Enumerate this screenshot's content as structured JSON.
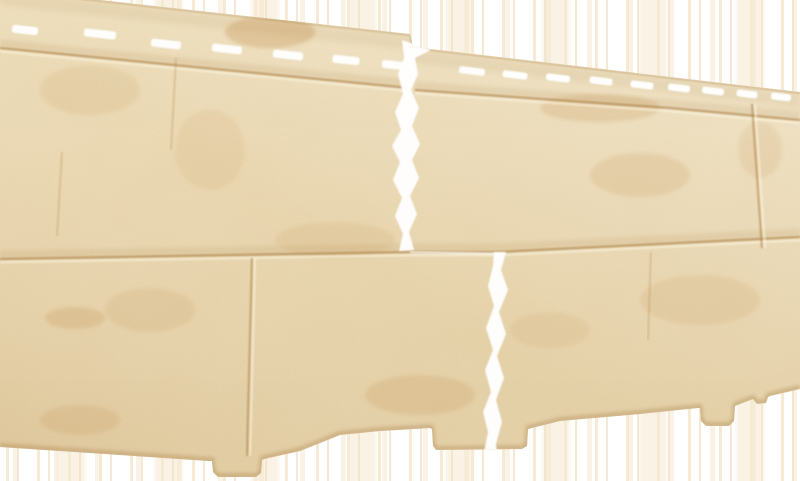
{
  "subject": "Beige stone-textured facade siding panel photographed at an angle on a white background",
  "palette": {
    "bg": "#ffffff",
    "streak_a": "rgba(246,233,210,0.95)",
    "streak_b": "rgba(240,224,193,0.7)",
    "streak_c": "rgba(243,229,203,0.5)",
    "panel_base": "#e9d6a9",
    "grain_dark": "#c29a5e",
    "grain_light": "#f8efd2",
    "blotch": "#c08c4a",
    "seam": "#a97f45",
    "seam_highlight": "#fdf6e0",
    "slot": "#ffffff",
    "gap": "#ffffff",
    "edge_shadow": "#a87e48",
    "sheen_dark": "rgba(194,151,91,0.20)",
    "sheen_light": "rgba(255,253,244,0.33)",
    "vert_top": "rgba(255,251,238,0.20)",
    "vert_bottom": "rgba(176,136,78,0.12)"
  },
  "panel": {
    "outline": "M 0,-11 L 410,34 L 413,47 L 800,92 L 800,389 L 770,396 L 768,397 L 766,403 L 757,404 L 753,399 L 735,406 L 734,421 L 729,426 L 706,426 L 701,421 L 700,408 L 698,408 L 640,414 L 560,421 L 528,429 L 527,446 L 522,449 L 436,450 L 433,446 L 432,429 L 430,428 L 380,431 L 340,435 L 300,451 L 264,459 L 262,460 L 261,473 L 256,477 L 218,477 L 213,472 L 212,461 L 208,461 L 120,455 L 0,447 Z",
    "top_edge": "M 0,-11 L 410,34 L 413,47 L 800,92",
    "bottom_edge": "M 0,447 L 120,455 L 208,461 L 212,461 L 213,472 L 218,477 L 256,477 L 261,473 L 262,460 L 264,459 L 300,451 L 340,435 L 380,431 L 430,428 L 432,429 L 433,446 L 436,450 L 522,449 L 527,446 L 528,429 L 560,421 L 640,414 L 698,408 L 700,408 L 701,421 L 706,426 L 729,426 L 734,421 L 735,406 L 753,399 L 757,404 L 766,403 L 768,397 L 770,396 L 800,389",
    "seams_major": [
      [
        [
          0,
          48
        ],
        [
          410,
          88
        ]
      ],
      [
        [
          415,
          90
        ],
        [
          670,
          108
        ],
        [
          800,
          120
        ]
      ],
      [
        [
          0,
          259
        ],
        [
          410,
          252
        ],
        [
          497,
          252
        ],
        [
          800,
          237
        ]
      ]
    ],
    "seams_vertical": [
      [
        [
          752,
          104
        ],
        [
          762,
          248
        ]
      ],
      [
        [
          252,
          258
        ],
        [
          247,
          456
        ]
      ]
    ],
    "seams_faint": [
      [
        [
          176,
          58
        ],
        [
          171,
          150
        ]
      ],
      [
        [
          62,
          152
        ],
        [
          57,
          236
        ]
      ],
      [
        [
          651,
          252
        ],
        [
          648,
          340
        ]
      ]
    ],
    "joint_gaps": [
      "M 402,40 L 431,50 L 415,58 L 418,74 L 411,90 L 419,108 L 412,126 L 420,144 L 412,160 L 419,178 L 410,196 L 417,214 L 409,232 L 414,250 L 399,251 L 403,234 L 395,216 L 402,198 L 393,180 L 400,162 L 392,146 L 401,130 L 395,112 L 403,94 L 398,74 L 404,58 Z",
      "M 506,252 L 501,270 L 508,290 L 499,312 L 506,334 L 497,356 L 504,378 L 496,400 L 502,422 L 496,444 L 497,453 L 484,452 L 488,432 L 483,412 L 491,392 L 485,370 L 493,350 L 486,328 L 494,306 L 488,286 L 493,266 L 494,252 Z"
    ],
    "joint_seam_sliver": "M 410,252 L 497,254",
    "slots": {
      "angle_left": 6.3,
      "angle_right": 7.0,
      "h_left": 8,
      "h_right": 7,
      "left": [
        [
          25,
          30,
          26
        ],
        [
          100,
          34,
          32
        ],
        [
          166,
          44,
          30
        ],
        [
          227,
          49,
          30
        ],
        [
          288,
          55,
          30
        ],
        [
          346,
          60,
          27
        ],
        [
          394,
          65,
          24
        ]
      ],
      "right": [
        [
          472,
          71,
          26
        ],
        [
          515,
          75,
          25
        ],
        [
          558,
          78,
          24
        ],
        [
          601,
          81,
          23
        ],
        [
          642,
          85,
          23
        ],
        [
          679,
          88,
          22
        ],
        [
          713,
          91,
          22
        ],
        [
          747,
          94,
          21
        ],
        [
          781,
          97,
          20
        ]
      ]
    },
    "stains": [
      [
        270,
        32,
        45,
        16,
        0.3
      ],
      [
        600,
        108,
        60,
        14,
        0.2
      ],
      [
        640,
        175,
        50,
        22,
        0.16
      ],
      [
        700,
        300,
        60,
        25,
        0.13
      ],
      [
        420,
        395,
        55,
        20,
        0.18
      ],
      [
        150,
        310,
        45,
        22,
        0.13
      ],
      [
        80,
        420,
        40,
        15,
        0.16
      ],
      [
        550,
        330,
        40,
        18,
        0.11
      ],
      [
        760,
        150,
        22,
        28,
        0.13
      ],
      [
        210,
        150,
        35,
        40,
        0.1
      ],
      [
        335,
        240,
        60,
        18,
        0.12
      ],
      [
        90,
        90,
        50,
        25,
        0.12
      ],
      [
        75,
        318,
        30,
        11,
        0.22
      ]
    ]
  }
}
